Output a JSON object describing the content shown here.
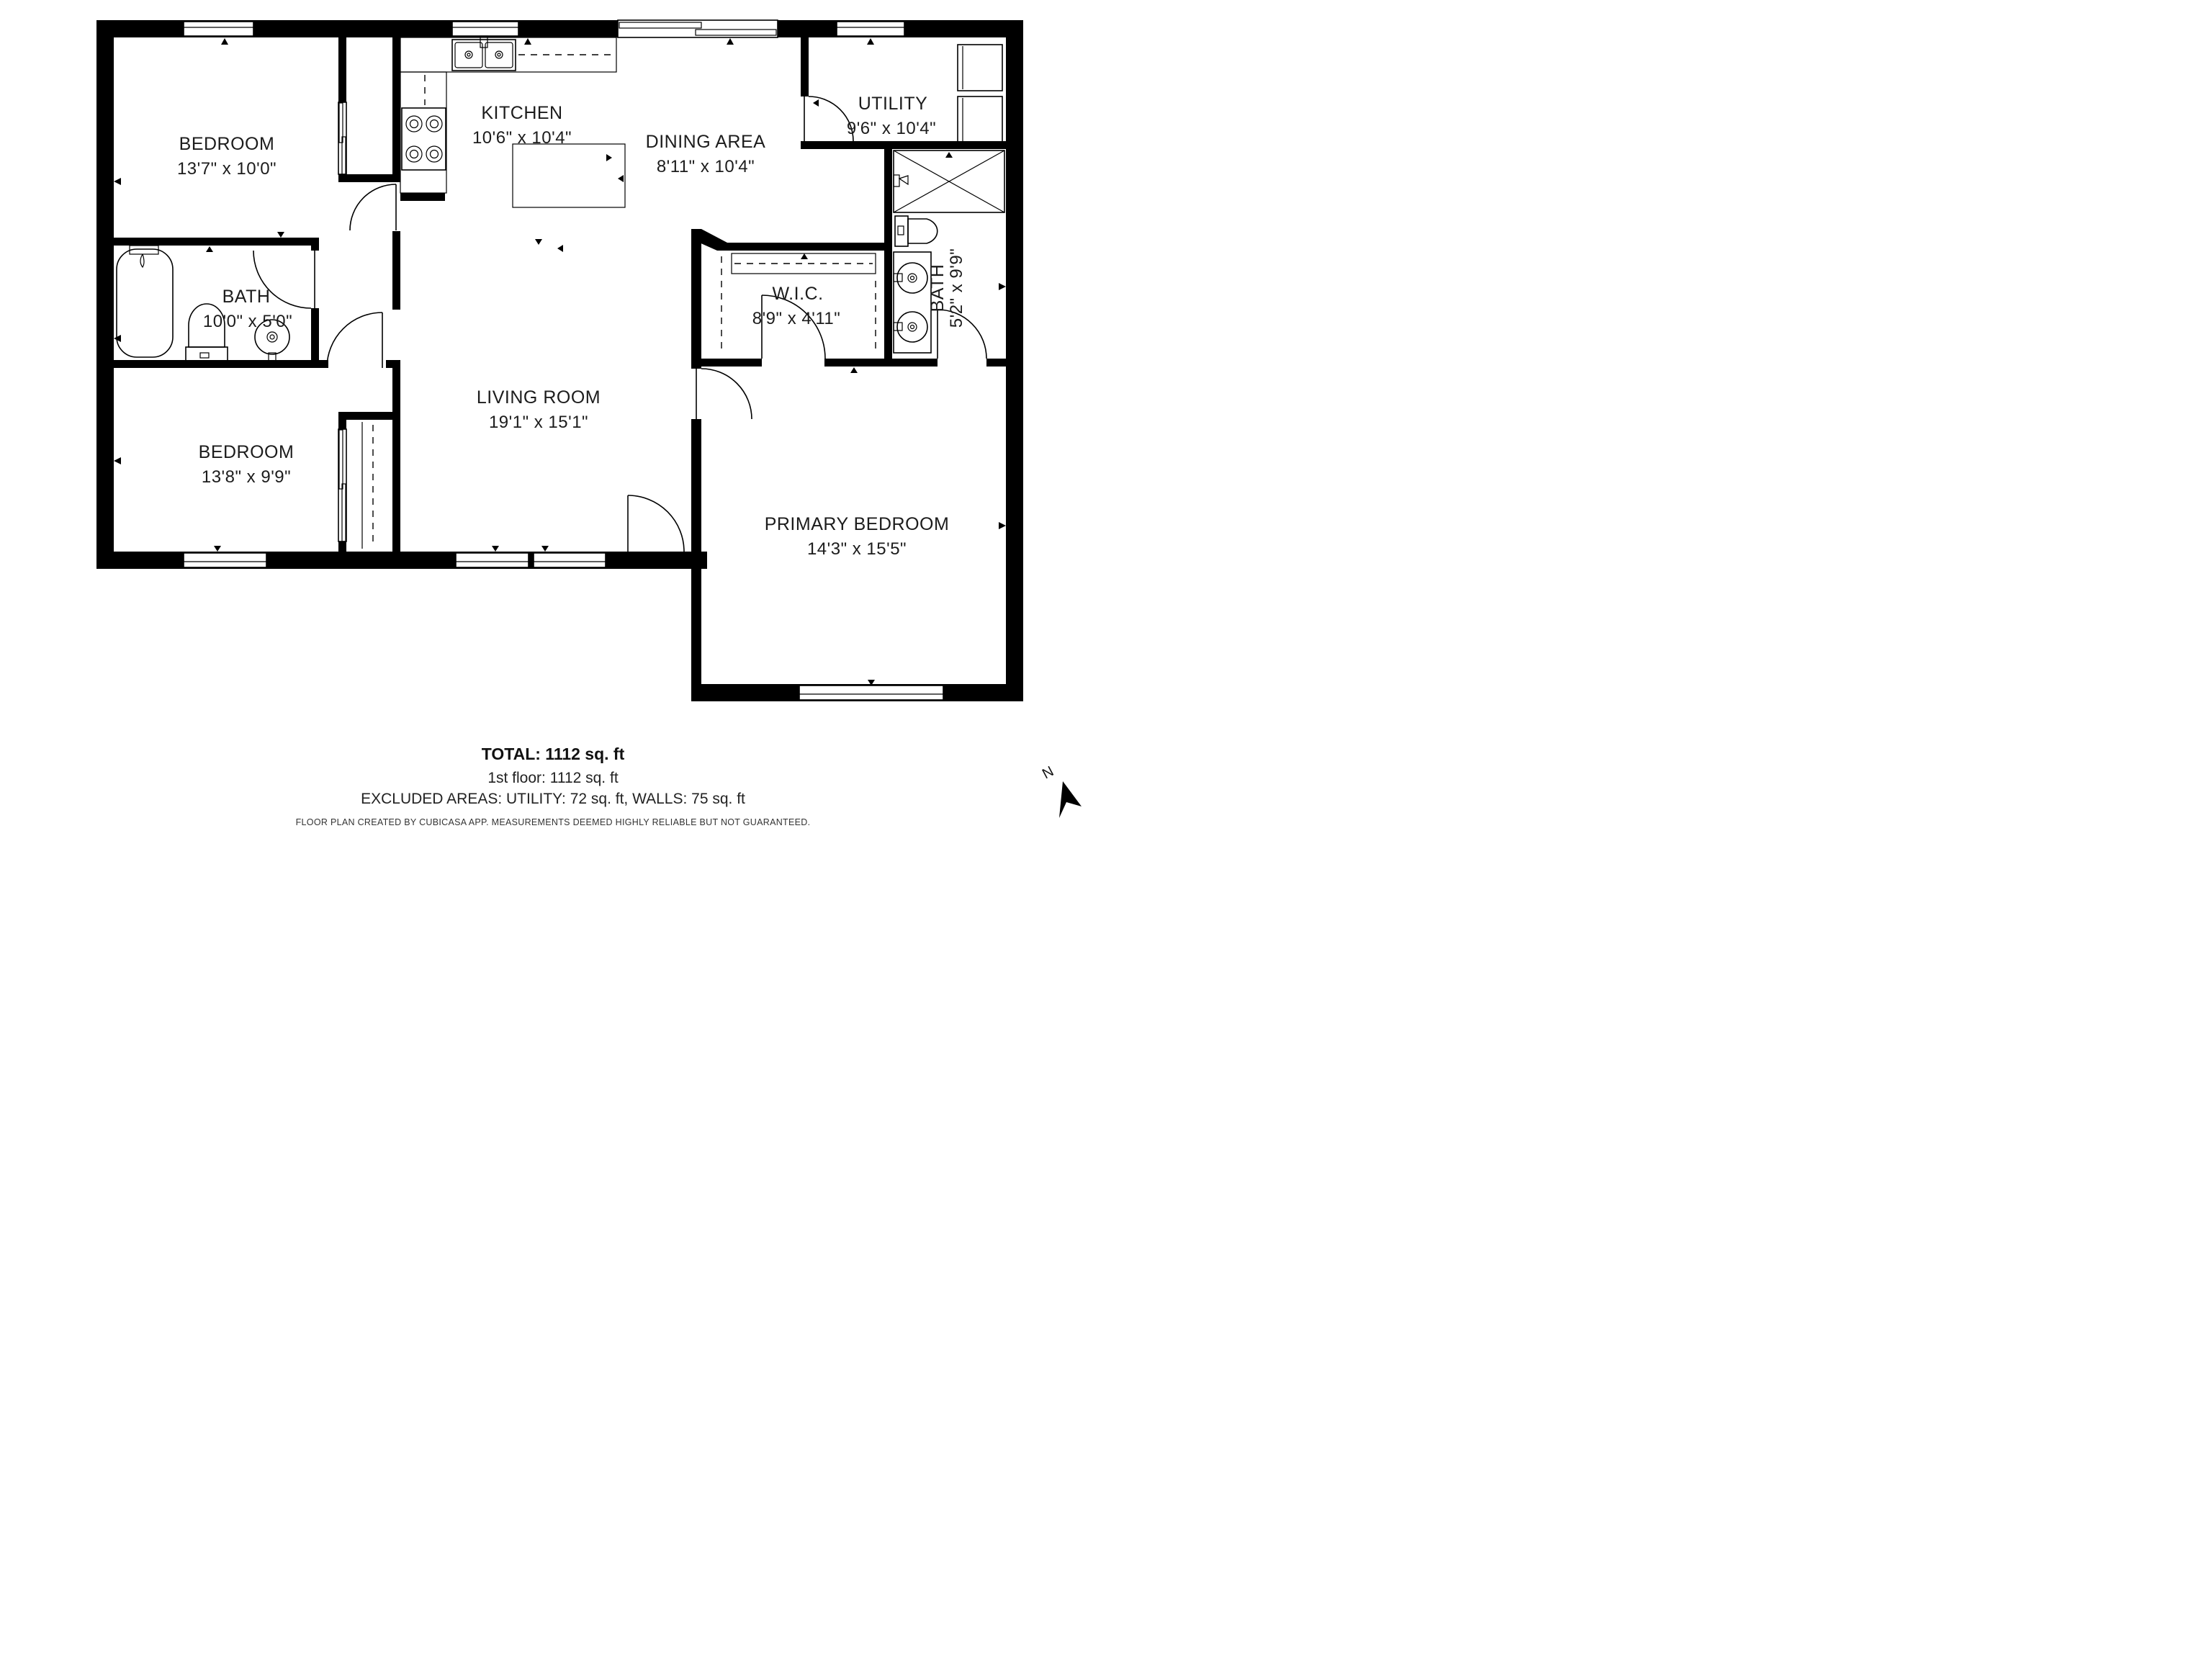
{
  "plan": {
    "rooms": [
      {
        "id": "bedroom-1",
        "name": "BEDROOM",
        "dims": "13'7\" x 10'0\""
      },
      {
        "id": "kitchen",
        "name": "KITCHEN",
        "dims": "10'6\" x 10'4\""
      },
      {
        "id": "dining-area",
        "name": "DINING AREA",
        "dims": "8'11\" x 10'4\""
      },
      {
        "id": "utility",
        "name": "UTILITY",
        "dims": "9'6\" x 10'4\""
      },
      {
        "id": "bath-1",
        "name": "BATH",
        "dims": "10'0\" x 5'0\""
      },
      {
        "id": "wic",
        "name": "W.I.C.",
        "dims": "8'9\" x 4'11\""
      },
      {
        "id": "bath-2",
        "name": "BATH",
        "dims": "5'2\" x 9'9\""
      },
      {
        "id": "living-room",
        "name": "LIVING ROOM",
        "dims": "19'1\" x 15'1\""
      },
      {
        "id": "bedroom-2",
        "name": "BEDROOM",
        "dims": "13'8\" x 9'9\""
      },
      {
        "id": "primary-bedroom",
        "name": "PRIMARY BEDROOM",
        "dims": "14'3\" x 15'5\""
      }
    ]
  },
  "summary": {
    "total": "TOTAL: 1112 sq. ft",
    "floor": "1st floor: 1112 sq. ft",
    "excluded": "EXCLUDED AREAS: UTILITY: 72 sq. ft, WALLS: 75 sq. ft"
  },
  "disclaimer": "FLOOR PLAN CREATED BY CUBICASA APP. MEASUREMENTS DEEMED HIGHLY RELIABLE BUT NOT GUARANTEED.",
  "compass": {
    "label": "N"
  },
  "colors": {
    "wall": "#000000",
    "background": "#ffffff",
    "text": "#1c1c1c"
  }
}
